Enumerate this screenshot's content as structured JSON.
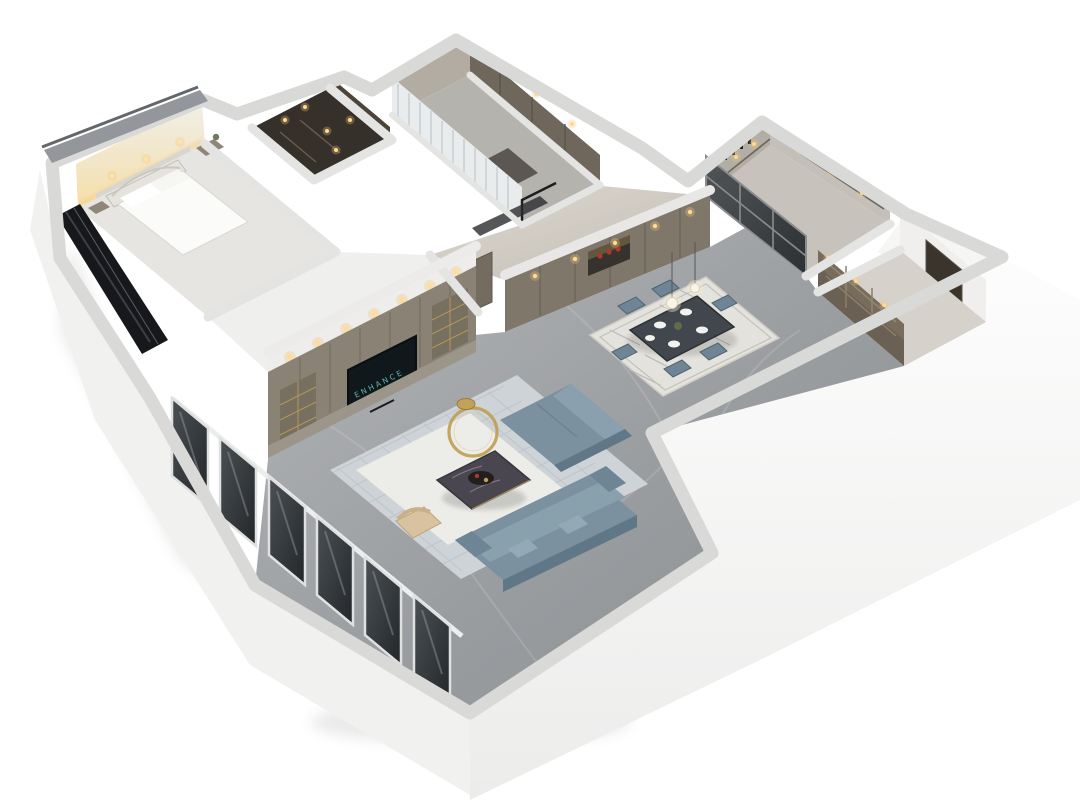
{
  "scene": {
    "type": "3d-dollhouse-floorplan-render",
    "view": "axonometric-cutaway",
    "rooms": [
      {
        "name": "master-bedroom"
      },
      {
        "name": "walk-in-closet"
      },
      {
        "name": "second-bedroom"
      },
      {
        "name": "kitchen"
      },
      {
        "name": "pantry-hall"
      },
      {
        "name": "hallway"
      },
      {
        "name": "dining-room"
      },
      {
        "name": "living-room"
      },
      {
        "name": "balcony-window-wall"
      }
    ]
  },
  "tv": {
    "logo_text": "ENHANCE"
  },
  "palette": {
    "bg": "#ffffff",
    "wall_top": "#d9d9d8",
    "wall_face_w": "#f1f1f0",
    "roof_strip": "#93969a",
    "bedroom_floor": "#e7e5e1",
    "bed_white": "#fbfbf9",
    "wallpaper": "#d8d6d1",
    "cove_glow": "#f2cf8f",
    "closet_floor": "#35302a",
    "wood_dark": "#4d4338",
    "curtain": "#e9eced",
    "wardrobe": "#6f675c",
    "bedroom2_wall": "#b3aca2",
    "bedroom2_floor": "#b5b3ae",
    "kitchen_cabinet": "#b2ada5",
    "kitchen_floor": "#c7c3bc",
    "glass_dark": "#23272a",
    "bronze_cabinet": "#6b6054",
    "door_dark": "#3b342d",
    "pantry_floor": "#d6d2cb",
    "taupe_wall": "#7e776a",
    "taupe_door": "#736c5f",
    "hall_floor": "#d6d2ca",
    "media_wall": "#8a8375",
    "media_base": "#9c968a",
    "shelf_gold": "#b2975c",
    "tv_screen": "#10181b",
    "tv_text": "#6fd3c6",
    "sofa": "#7b91a0",
    "sofa_light": "#8aa0ae",
    "sofa_dark": "#5f7787",
    "rug_living": "#cdd3d6",
    "rug_white": "#edece8",
    "coffee_table": "#494650",
    "gold": "#bf9f54",
    "beige_chair": "#d8c2a0",
    "dining_rug": "#e4e2dc",
    "dining_chair": "#6f8595",
    "dining_table": "#41474c",
    "red_accent": "#b03727",
    "warm_light": "#ffd98e",
    "window_glass": "#17181b",
    "window_frame": "#dfe0e0",
    "plate": "#f2f2f0",
    "plant": "#5d6b4f"
  }
}
